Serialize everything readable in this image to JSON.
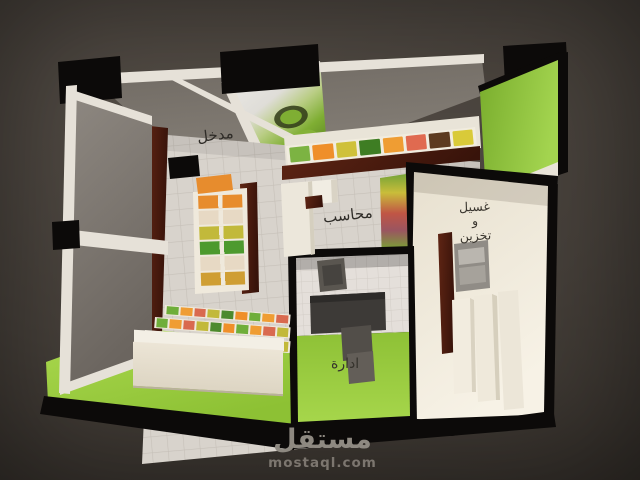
{
  "scene": {
    "description": "3D rendered floor plan of a fruit and vegetable shop, top perspective view",
    "labels": {
      "entrance": "مدخل",
      "cashier": "محاسب",
      "washing_line1": "غسيل",
      "washing_line2": "و",
      "washing_line3": "تخزين",
      "admin": "ادارة"
    },
    "watermark": {
      "logo": "مستقل",
      "site": "mostaql.com"
    },
    "colors": {
      "background_light": "#564f48",
      "background": "#46403a",
      "background_edge": "#332e29",
      "floor_green": "#9ccd3e",
      "wall_green": "#8cc43c",
      "tile": "#d8d3cc",
      "tile_line": "#c6c0b8",
      "cream": "#efe9dc",
      "maroon": "#4f1d11",
      "wall_black": "#0c0a09",
      "canopy": "#766f68",
      "beam": "#e6e1d8",
      "desk": "#3d3a37",
      "watermark_text": "#8e8981"
    },
    "produce": {
      "shelf_bins": [
        "#7cb342",
        "#ef8f2a",
        "#cfc13a",
        "#3e7d23",
        "#ef9d33",
        "#e06a50",
        "#5d3b20",
        "#d9ca39"
      ],
      "gondola_rows": [
        "#e78c2d",
        "#e7d9c4",
        "#c2b93a",
        "#4d9a2e",
        "#e7d9c4",
        "#cf9e33"
      ],
      "tier_segments": [
        "#6fae3a",
        "#ef9d33",
        "#d96a4f",
        "#c2b93a",
        "#4d8a2e",
        "#ef8f2a"
      ]
    }
  }
}
